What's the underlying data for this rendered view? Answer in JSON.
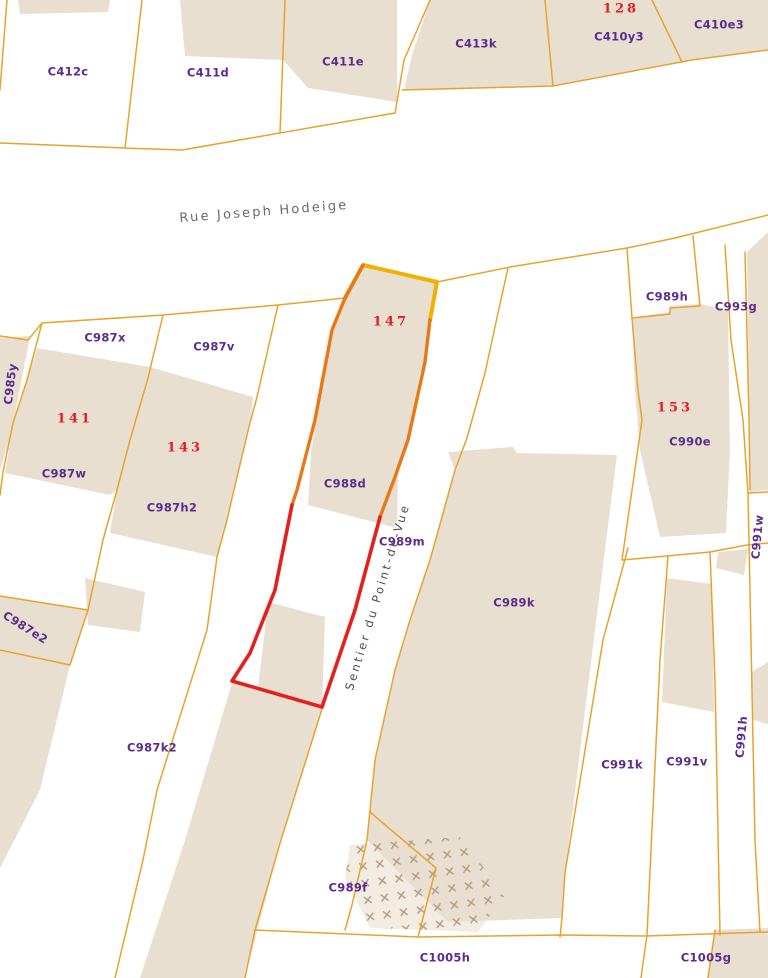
{
  "map": {
    "type": "cadastral-parcel-map",
    "streets": [
      {
        "text": "Rue Joseph Hodeige"
      },
      {
        "text": "Sentier du Point-de-Vue"
      }
    ],
    "house_numbers": [
      {
        "text": "128"
      },
      {
        "text": "147"
      },
      {
        "text": "141"
      },
      {
        "text": "143"
      },
      {
        "text": "153"
      }
    ],
    "labels": {
      "parcels": [
        {
          "text": "C412c"
        },
        {
          "text": "C411d"
        },
        {
          "text": "C411e"
        },
        {
          "text": "C413k"
        },
        {
          "text": "C410y3"
        },
        {
          "text": "C410e3"
        },
        {
          "text": "C987x"
        },
        {
          "text": "C987v"
        },
        {
          "text": "C985y"
        },
        {
          "text": "C987w"
        },
        {
          "text": "C987h2"
        },
        {
          "text": "C987e2"
        },
        {
          "text": "C987k2"
        },
        {
          "text": "C988d"
        },
        {
          "text": "C989m"
        },
        {
          "text": "C989k"
        },
        {
          "text": "C989h"
        },
        {
          "text": "C993g"
        },
        {
          "text": "C990e"
        },
        {
          "text": "C991w"
        },
        {
          "text": "C991k"
        },
        {
          "text": "C991v"
        },
        {
          "text": "C991h"
        },
        {
          "text": "C989f"
        },
        {
          "text": "C1005h"
        },
        {
          "text": "C1005g"
        }
      ]
    },
    "colors": {
      "building_fill": "#e9dfd0",
      "parcel_line": "#e7a32e",
      "selected_parcel_outline": "#e3201d",
      "strip_outline_orange": "#e87917",
      "strip_outline_yellow": "#f2b000",
      "parcel_label": "#5b2c8f",
      "house_number_label": "#e41d1f",
      "street_label": "#6b6b6b",
      "hatch_mark": "#b39b7d"
    }
  }
}
